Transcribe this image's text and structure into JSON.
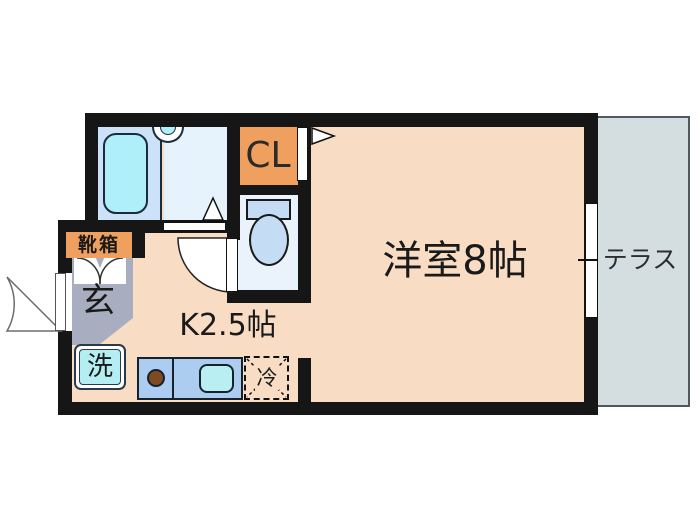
{
  "floorplan": {
    "rooms": {
      "western_room": {
        "label": "洋室8帖"
      },
      "kitchen": {
        "label": "K2.5帖"
      },
      "terrace": {
        "label": "テラス"
      },
      "closet": {
        "label": "CL"
      },
      "entrance": {
        "label": "玄"
      },
      "shoe_box": {
        "label": "靴箱"
      },
      "washer": {
        "label": "洗"
      },
      "refrigerator": {
        "label": "冷"
      }
    },
    "colors": {
      "wall": "#161616",
      "room_floor": "#f8dcc4",
      "terrace_floor": "#d4dee0",
      "bath_floor_left": "#cbe2f9",
      "bath_floor_right": "#e6f3fd",
      "bathtub": "#aeeffa",
      "toilet_floor": "#eaf2fb",
      "fixture_blue": "#c4dcf4",
      "kitchen_counter": "#accdf0",
      "counter_sink": "#b9eef2",
      "stove_burner": "#7d4a21",
      "entrance_floor": "#a8aebf",
      "accent_orange": "#efa05e",
      "washer_fill": "#b5eef2"
    }
  }
}
